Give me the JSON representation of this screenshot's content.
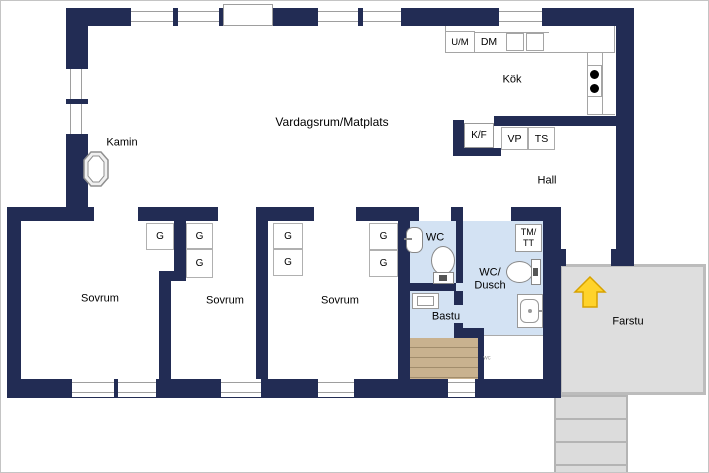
{
  "rooms": {
    "living": "Vardagsrum/Matplats",
    "kitchen": "Kök",
    "hall": "Hall",
    "bedroom": "Sovrum",
    "wc": "WC",
    "wc_shower_1": "WC/",
    "wc_shower_2": "Dusch",
    "sauna": "Bastu",
    "porch": "Farstu",
    "fireplace": "Kamin"
  },
  "fixtures": {
    "washer_combo": "U/M",
    "dishwasher": "DM",
    "fridge_freezer": "K/F",
    "heat_pump": "VP",
    "dryer_cabinet": "TS",
    "laundry_1": "TM/",
    "laundry_2": "TT",
    "wardrobe": "G",
    "small_note": "wc"
  },
  "colors": {
    "wall": "#222c54",
    "wet_room_floor": "#d3e2f3",
    "sauna_wood": "#c9b28f",
    "sauna_wood_line": "#a28d6c",
    "porch_fill": "#dedede",
    "porch_border": "#bcbcbc",
    "arrow_fill": "#ffd32a",
    "arrow_stroke": "#d7a200",
    "window_line": "#9e9e9e"
  }
}
